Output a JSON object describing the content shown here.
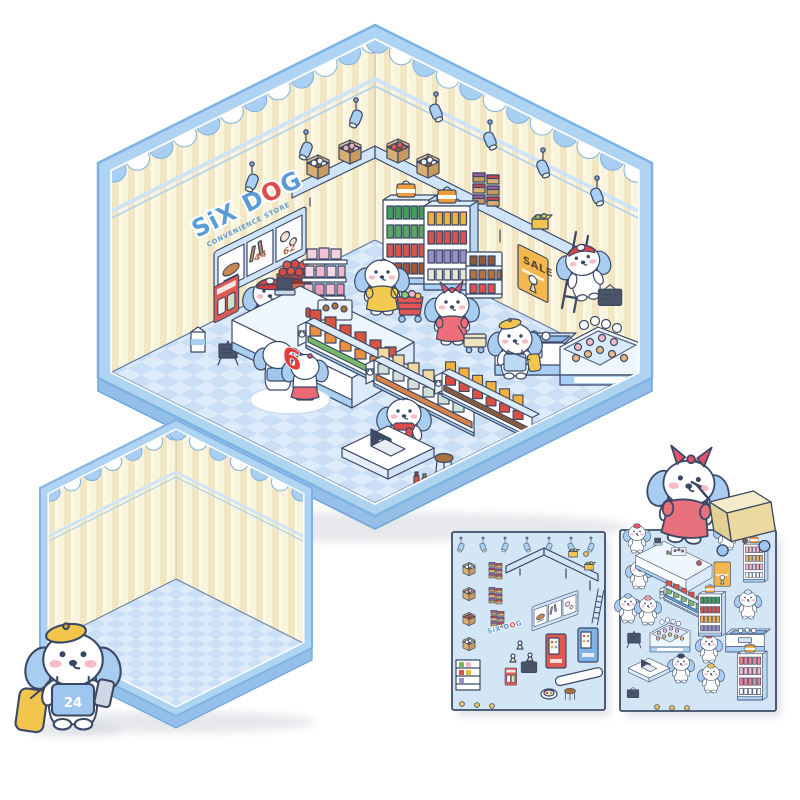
{
  "product": {
    "store_sign": {
      "parts": [
        "SiX D",
        "O",
        "G"
      ],
      "subtitle": "CONVENIENCE STORE"
    },
    "menu_board": {
      "prices": [
        "44",
        "62"
      ]
    },
    "sale_poster": {
      "text": "SALE"
    },
    "counter_badge": "6",
    "delivery_dog": {
      "badge": "24"
    }
  },
  "palette": {
    "border_blue": "#aed3f3",
    "border_edge": "#7fb2e2",
    "depth_blue": "#93bfe9",
    "wall_cream": "#fbf4dc",
    "wall_stripe": "#f3e7c3",
    "floor_light": "#ddebfb",
    "floor_check": "#cadff6",
    "outline_navy": "#3a4866",
    "accent_red": "#e23c3c",
    "accent_yellow": "#f2c54d",
    "dog_ear_blue": "#a8cdf0",
    "cheek_pink": "#f7bdc7",
    "sheet_bg": "#d3e6f6",
    "sheet_border": "#3e4c68"
  },
  "store_scene": {
    "items": [
      {
        "t": "spotlight",
        "x": 252,
        "y": 182,
        "n": "ceiling-spotlight"
      },
      {
        "t": "spotlight",
        "x": 306,
        "y": 150,
        "n": "ceiling-spotlight"
      },
      {
        "t": "spotlight",
        "x": 356,
        "y": 118,
        "n": "ceiling-spotlight"
      },
      {
        "t": "spotlight",
        "x": 436,
        "y": 112,
        "f": 1,
        "n": "ceiling-spotlight"
      },
      {
        "t": "spotlight",
        "x": 490,
        "y": 140,
        "f": 1,
        "n": "ceiling-spotlight"
      },
      {
        "t": "spotlight",
        "x": 543,
        "y": 168,
        "f": 1,
        "n": "ceiling-spotlight"
      },
      {
        "t": "spotlight",
        "x": 597,
        "y": 196,
        "f": 1,
        "n": "ceiling-spotlight"
      },
      {
        "t": "box-open",
        "x": 318,
        "y": 176,
        "c": {
          "items": "#ffffff"
        },
        "n": "shelf-box-buns"
      },
      {
        "t": "box-open",
        "x": 350,
        "y": 161,
        "c": {
          "items": "#e8b0b8"
        },
        "n": "shelf-box-pink"
      },
      {
        "t": "box-open",
        "x": 398,
        "y": 160,
        "c": {
          "items": "#d95b4e"
        },
        "n": "shelf-box-red"
      },
      {
        "t": "box-open",
        "x": 428,
        "y": 175,
        "c": {
          "items": "#f3f3f3"
        },
        "n": "shelf-box-white"
      },
      {
        "t": "box-stack",
        "x": 487,
        "y": 204,
        "n": "carton-stack"
      },
      {
        "t": "box-yellow",
        "x": 540,
        "y": 229,
        "n": "shelf-box-yellow"
      },
      {
        "t": "milk",
        "x": 198,
        "y": 352,
        "n": "milk-carton-standee"
      },
      {
        "t": "aframe",
        "x": 228,
        "y": 365,
        "n": "a-frame-sign"
      },
      {
        "t": "crate-red",
        "x": 294,
        "y": 300,
        "n": "hot-food-crate"
      },
      {
        "t": "shelf-pink",
        "x": 323,
        "y": 308,
        "n": "pink-cake-shelf"
      },
      {
        "t": "fridge",
        "x": 406,
        "y": 284,
        "c": {
          "r1": "#3f9e57",
          "r2": "#57a860",
          "r3": "#d9534f",
          "r4": "#a3543a"
        },
        "n": "drink-fridge-green"
      },
      {
        "t": "fridge",
        "x": 447,
        "y": 290,
        "c": {
          "r1": "#f0b43c",
          "r2": "#d9534f",
          "r3": "#9b8ec4",
          "r4": "#e8e3da"
        },
        "n": "drink-fridge-mixed"
      },
      {
        "t": "choc-shelf",
        "x": 484,
        "y": 298,
        "n": "chocolate-shelf"
      },
      {
        "t": "ladder",
        "x": 562,
        "y": 308,
        "n": "ladder"
      },
      {
        "t": "dog-ladder",
        "x": 588,
        "y": 298,
        "n": "dog-on-ladder"
      },
      {
        "t": "chalk-sign",
        "x": 610,
        "y": 300,
        "s": 0.9,
        "n": "held-chalkboard"
      },
      {
        "t": "dog-cashier",
        "x": 270,
        "y": 332,
        "n": "cashier-dog"
      },
      {
        "t": "counter",
        "x": 352,
        "y": 378,
        "n": "checkout-counter"
      },
      {
        "t": "dog-yellow",
        "x": 382,
        "y": 313,
        "c": {
          "dress": "#f4c94f"
        },
        "n": "shopper-dog-yellow-dress"
      },
      {
        "t": "cart-red",
        "x": 410,
        "y": 317,
        "n": "red-shopping-cart"
      },
      {
        "t": "mat",
        "x": 290,
        "y": 400,
        "n": "floor-mat"
      },
      {
        "t": "dog-back",
        "x": 278,
        "y": 390,
        "n": "dog-couple-left"
      },
      {
        "t": "dog-skirt",
        "x": 305,
        "y": 400,
        "n": "dog-couple-right"
      },
      {
        "t": "gondola",
        "x": 306,
        "y": 348,
        "c": {
          "c1": "#d9543f",
          "c2": "#e98f3f",
          "c3": "#79b869"
        },
        "n": "snack-gondola"
      },
      {
        "t": "dog-pink",
        "x": 452,
        "y": 343,
        "c": {
          "dress": "#ee6e79"
        },
        "n": "shopper-dog-pink-bow"
      },
      {
        "t": "basket",
        "x": 475,
        "y": 350,
        "n": "cream-shopping-trolley"
      },
      {
        "t": "gondola",
        "x": 374,
        "y": 386,
        "c": {
          "c1": "#f2d9a0",
          "c2": "#cfe0d8",
          "c3": "#d9824a"
        },
        "n": "bottle-gondola"
      },
      {
        "t": "gondola",
        "x": 442,
        "y": 396,
        "s": 0.9,
        "c": {
          "c1": "#f2b13c",
          "c2": "#d94f43",
          "c3": "#8a5b3b"
        },
        "n": "juice-gondola"
      },
      {
        "t": "freezer",
        "x": 530,
        "y": 375,
        "n": "ice-cream-freezer"
      },
      {
        "t": "dog-beret",
        "x": 515,
        "y": 377,
        "n": "dog-yellow-beret"
      },
      {
        "t": "bakery",
        "x": 600,
        "y": 385,
        "n": "bakery-display"
      },
      {
        "t": "dog-scarf",
        "x": 404,
        "y": 452,
        "n": "laptop-dog"
      },
      {
        "t": "table-laptop",
        "x": 388,
        "y": 470,
        "n": "cafe-table"
      },
      {
        "t": "stool",
        "x": 444,
        "y": 468,
        "n": "wooden-stool"
      },
      {
        "t": "condiments",
        "x": 420,
        "y": 487,
        "n": "condiment-bottles"
      }
    ]
  },
  "sticker_sheets": [
    {
      "name": "fixtures-sticker-sheet",
      "items": [
        {
          "t": "spotlight",
          "x": 461,
          "y": 547,
          "s": 0.5
        },
        {
          "t": "spotlight",
          "x": 483,
          "y": 547,
          "s": 0.5,
          "f": 1
        },
        {
          "t": "spotlight",
          "x": 505,
          "y": 547,
          "s": 0.5
        },
        {
          "t": "spotlight",
          "x": 527,
          "y": 547,
          "s": 0.5,
          "f": 1
        },
        {
          "t": "spotlight",
          "x": 549,
          "y": 547,
          "s": 0.5
        },
        {
          "t": "spotlight",
          "x": 571,
          "y": 547,
          "s": 0.5,
          "f": 1
        },
        {
          "t": "spotlight",
          "x": 591,
          "y": 547,
          "s": 0.5
        },
        {
          "t": "box-open",
          "x": 469,
          "y": 574,
          "s": 0.55,
          "c": {
            "items": "#ffffff"
          }
        },
        {
          "t": "box-open",
          "x": 469,
          "y": 599,
          "s": 0.55,
          "c": {
            "items": "#e8b0b8"
          }
        },
        {
          "t": "box-open",
          "x": 469,
          "y": 624,
          "s": 0.55,
          "c": {
            "items": "#d95b4e"
          }
        },
        {
          "t": "box-open",
          "x": 469,
          "y": 649,
          "s": 0.55,
          "c": {
            "items": "#f3f3f3"
          }
        },
        {
          "t": "box-stack",
          "x": 496,
          "y": 578,
          "s": 0.5
        },
        {
          "t": "box-stack",
          "x": 496,
          "y": 603,
          "s": 0.5
        },
        {
          "t": "box-stack",
          "x": 498,
          "y": 626,
          "s": 0.5
        },
        {
          "t": "lshelf",
          "x": 506,
          "y": 560
        },
        {
          "t": "box-yellow",
          "x": 573,
          "y": 557,
          "s": 0.55
        },
        {
          "t": "box-yellow",
          "x": 589,
          "y": 570,
          "s": 0.55
        },
        {
          "t": "menu-board",
          "x": 532,
          "y": 607,
          "s": 0.5,
          "sk": -20
        },
        {
          "t": "vending",
          "x": 546,
          "y": 668,
          "c": {
            "vb": "#e05a52"
          }
        },
        {
          "t": "vending",
          "x": 578,
          "y": 662,
          "c": {
            "vb": "#7fb3e6"
          }
        },
        {
          "t": "ladder",
          "x": 592,
          "y": 623,
          "s": 0.45
        },
        {
          "t": "chalk-sign",
          "x": 529,
          "y": 669,
          "s": 0.6
        },
        {
          "t": "poster-red",
          "x": 505,
          "y": 668,
          "s": 0.45
        },
        {
          "t": "mini-shelf",
          "x": 468,
          "y": 690
        },
        {
          "t": "bench",
          "x": 580,
          "y": 681
        },
        {
          "t": "sushi",
          "x": 549,
          "y": 694
        },
        {
          "t": "stool",
          "x": 570,
          "y": 697,
          "s": 0.6
        },
        {
          "t": "egg",
          "x": 520,
          "y": 649
        },
        {
          "t": "egg",
          "x": 530,
          "y": 661
        },
        {
          "t": "egg",
          "x": 513,
          "y": 662
        },
        {
          "t": "dot",
          "x": 462,
          "y": 704
        },
        {
          "t": "dot",
          "x": 477,
          "y": 705
        },
        {
          "t": "dot",
          "x": 492,
          "y": 706
        },
        {
          "t": "dot",
          "x": 586,
          "y": 554
        }
      ]
    },
    {
      "name": "characters-sticker-sheet",
      "items": [
        {
          "t": "dog-mini",
          "x": 637,
          "y": 552,
          "s": 0.5,
          "c": {
            "acc": "#e8506b"
          }
        },
        {
          "t": "dog-mini",
          "x": 727,
          "y": 549,
          "s": 0.5,
          "c": {
            "acc": "#f2c54d"
          }
        },
        {
          "t": "dog-mini",
          "x": 639,
          "y": 588,
          "s": 0.5,
          "c": {
            "acc": "#f3b9c6"
          }
        },
        {
          "t": "dog-mini",
          "x": 628,
          "y": 622,
          "s": 0.5,
          "c": {
            "acc": "#a8cdf0"
          }
        },
        {
          "t": "dog-mini",
          "x": 648,
          "y": 624,
          "s": 0.5,
          "c": {
            "acc": "#e8a0b0"
          }
        },
        {
          "t": "dog-mini",
          "x": 748,
          "y": 618,
          "s": 0.5,
          "c": {
            "acc": "#cfe2f7"
          }
        },
        {
          "t": "dog-mini",
          "x": 709,
          "y": 662,
          "s": 0.5,
          "c": {
            "acc": "#e8506b"
          }
        },
        {
          "t": "dog-mini",
          "x": 681,
          "y": 682,
          "s": 0.5,
          "c": {
            "acc": "#3a4866"
          }
        },
        {
          "t": "dog-mini",
          "x": 711,
          "y": 692,
          "s": 0.5,
          "c": {
            "acc": "#f2c54d"
          }
        },
        {
          "t": "counter",
          "x": 686,
          "y": 580,
          "s": 0.42
        },
        {
          "t": "poster-sale",
          "x": 714,
          "y": 562,
          "s": 0.55
        },
        {
          "t": "fridge",
          "x": 754,
          "y": 582,
          "s": 0.45,
          "c": {
            "r1": "#f3b9c6",
            "r2": "#e8b87c",
            "r3": "#f3b9c6",
            "r4": "#ffffff"
          }
        },
        {
          "t": "gondola",
          "x": 664,
          "y": 600,
          "s": 0.5,
          "c": {
            "c1": "#d9543f",
            "c2": "#79b869",
            "c3": "#5b9bd8"
          }
        },
        {
          "t": "fridge",
          "x": 710,
          "y": 636,
          "s": 0.5,
          "c": {
            "r1": "#3f9e57",
            "r2": "#d9534f",
            "r3": "#f0b43c",
            "r4": "#9b8ec4"
          }
        },
        {
          "t": "bakery",
          "x": 670,
          "y": 652,
          "s": 0.5
        },
        {
          "t": "aframe",
          "x": 634,
          "y": 648,
          "s": 0.7
        },
        {
          "t": "freezer",
          "x": 745,
          "y": 652,
          "s": 0.55
        },
        {
          "t": "table-laptop",
          "x": 649,
          "y": 678,
          "s": 0.45
        },
        {
          "t": "fridge",
          "x": 750,
          "y": 700,
          "s": 0.55,
          "c": {
            "r1": "#e8849a",
            "r2": "#f3b9c6",
            "r3": "#e8849a",
            "r4": "#ffffff"
          }
        },
        {
          "t": "chalk-sign",
          "x": 633,
          "y": 695,
          "s": 0.45
        },
        {
          "t": "dot",
          "x": 657,
          "y": 707
        },
        {
          "t": "dot",
          "x": 672,
          "y": 708
        },
        {
          "t": "dot",
          "x": 687,
          "y": 708
        },
        {
          "t": "dot",
          "x": 681,
          "y": 537,
          "c": {
            "dc": "#d9534f"
          }
        },
        {
          "t": "dot",
          "x": 699,
          "y": 563,
          "c": {
            "dc": "#d9534f"
          }
        },
        {
          "t": "dot",
          "x": 745,
          "y": 541,
          "c": {
            "dc": "#8a5b3b"
          }
        }
      ]
    }
  ]
}
